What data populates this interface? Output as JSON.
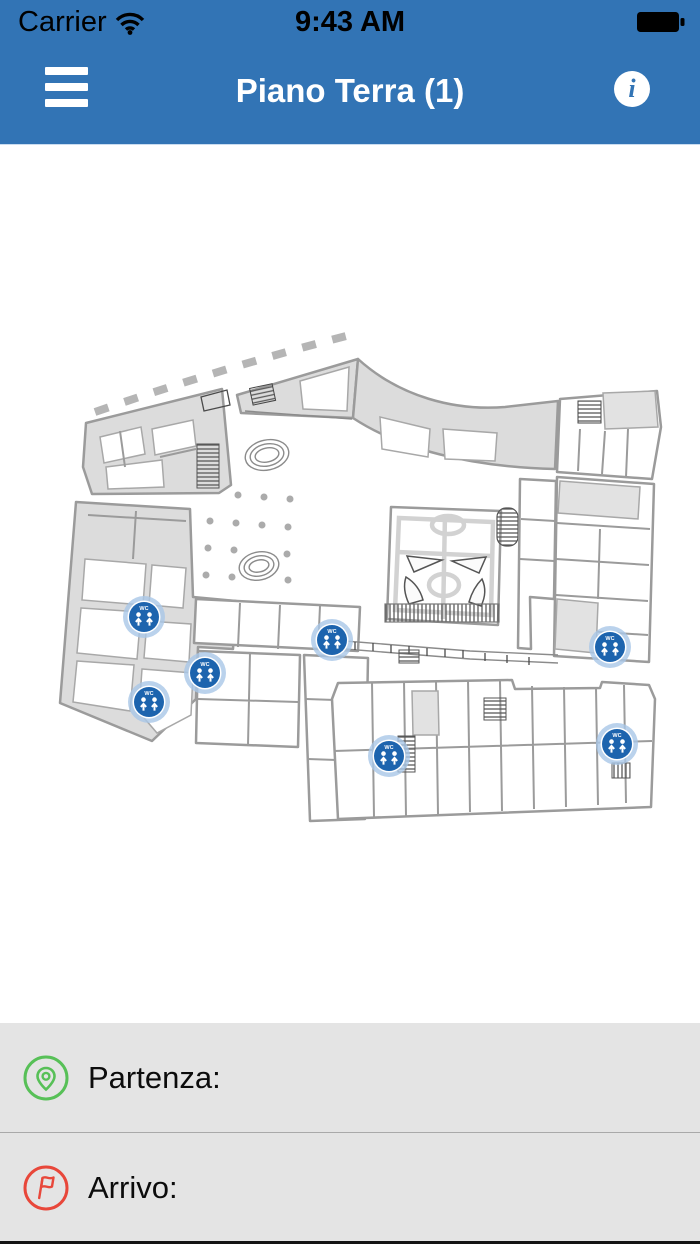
{
  "status_bar": {
    "carrier": "Carrier",
    "time": "9:43 AM",
    "wifi_icon": "wifi-icon",
    "battery_icon": "battery-icon"
  },
  "nav_bar": {
    "title": "Piano Terra (1)",
    "menu_icon": "hamburger-menu-icon",
    "info_icon": "info-icon",
    "info_glyph": "i",
    "background_color": "#3274B5"
  },
  "map": {
    "type": "floor-plan",
    "floor_name": "Piano Terra",
    "marker_label": "WC",
    "marker_color": "#1D64AE",
    "marker_halo_color": "#A9C7E7",
    "markers": [
      {
        "x": 144,
        "y": 618,
        "label": "WC"
      },
      {
        "x": 332,
        "y": 641,
        "label": "WC"
      },
      {
        "x": 205,
        "y": 674,
        "label": "WC"
      },
      {
        "x": 149,
        "y": 703,
        "label": "WC"
      },
      {
        "x": 610,
        "y": 648,
        "label": "WC"
      },
      {
        "x": 389,
        "y": 757,
        "label": "WC"
      },
      {
        "x": 617,
        "y": 745,
        "label": "WC"
      }
    ]
  },
  "route_panel": {
    "rows": [
      {
        "label": "Partenza:",
        "icon": "departure-pin-icon",
        "color": "#57C057"
      },
      {
        "label": "Arrivo:",
        "icon": "arrival-flag-icon",
        "color": "#E8473A"
      }
    ]
  }
}
